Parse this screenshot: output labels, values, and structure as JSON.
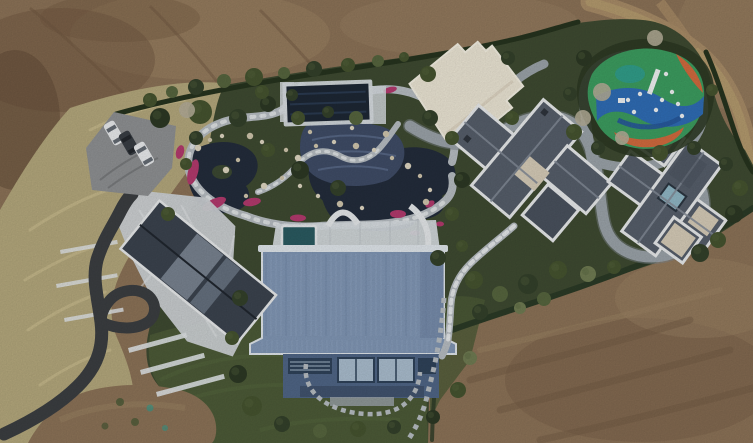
{
  "image": {
    "kind": "aerial drone photograph (top-down)",
    "subject": "Luxury landscaped estate compound surrounded by graded bare earth",
    "visible_text": "none"
  },
  "scene": {
    "surroundings": {
      "terrain": "bare brown dirt covering top-left, top-right and bottom-right",
      "dirt_track": "curving tan vehicle track in top-right corner",
      "bare_patch": "brown dirt patch at bottom-left with green spots"
    },
    "estate": {
      "boundary": "dark evergreen hedge line around the property",
      "garden": {
        "pond": "dark koi pond with rock edges and island",
        "cascade": "blue-gray stone cascade below pavilion",
        "paths": "winding light stone paths with white stepping stones",
        "flower_beds": "magenta flower drifts along pond and paths",
        "pavilion_pool": "dark navy rectangular pool/pavilion with white deck frame"
      },
      "buildings": [
        {
          "name": "stone-patio-house",
          "desc": "dark slate gable roof with glass skylight bands, white mosaic stone patio and terraced white steps"
        },
        {
          "name": "flat-roof-annex",
          "desc": "cream flat roof with notched corners"
        },
        {
          "name": "central-villa",
          "desc": "gray cross-plan hip roof with white trim and beige flat section"
        },
        {
          "name": "east-villa",
          "desc": "gray hip roof with white trim, beige flat corners and teal central skylight"
        },
        {
          "name": "blue-barn",
          "desc": "large steel-blue corrugated gable roof, window facade, rooftop terrace with plunge pool and white bridge"
        }
      ],
      "playground": "organic rubber-surface playground in green/blue/orange/teal swirls with white play equipment",
      "parking": {
        "cars": [
          {
            "color": "white"
          },
          {
            "color": "dark gray"
          },
          {
            "color": "white"
          }
        ],
        "surface": "gray pad in dry grass"
      },
      "driveway": "dark asphalt drive entering bottom-left with turnaround loop",
      "stairway": "stone stepping-stair path from central villa down to lawn",
      "vegetation": "dense evergreen shrubs and trees, several pale leafless trees, dry tan reed grass along the west side"
    }
  },
  "colors": {
    "dirt_base": "#8b7257",
    "dirt_dark": "#6f5740",
    "dirt_deep": "#5f4936",
    "dirt_light": "#9c8363",
    "dirt_pale": "#a78b67",
    "track_light": "#b49a6e",
    "dry_grass": "#b3a77c",
    "reed_light": "#cfc393",
    "garden_green": "#3e4a31",
    "lawn_green": "#4c5a37",
    "lawn_light": "#57683f",
    "hedge_dark": "#26331e",
    "hedge_mid": "#2b3a26",
    "shrub_deep": "#2c3824",
    "shrub_dark": "#33402a",
    "shrub_mid": "#45532f",
    "shrub_light": "#56653e",
    "shrub_pale": "#6f7b52",
    "tree_bare": "#b3ac97",
    "pond_water": "#232c3b",
    "island_green": "#3b4832",
    "cascade_blue": "#3f4c66",
    "cascade_line": "#5d6d8c",
    "stone_path": "#b6bcc1",
    "stone_white": "#e4e7e9",
    "rock_tan": "#cfc5ac",
    "rock_pale": "#ddd5c0",
    "flower_pink": "#b23a6d",
    "road_gray": "#9aa2a8",
    "road_edge": "#7e868c",
    "asphalt": "#3b3e41",
    "pad_gray": "#8e9092",
    "cream_roof": "#eae4d3",
    "cream_edge": "#f3efe2",
    "villa_roof": "#565e6a",
    "villa_roof_dark": "#49515d",
    "villa_ridge": "#838b97",
    "villa_trim": "#e7e9ea",
    "beige_flat": "#d5cbb7",
    "skylight_teal": "#8fb6c4",
    "pavilion_navy": "#1d2734",
    "pavilion_sheen": "#2a3a50",
    "deck_white": "#d6dbdf",
    "blue_roof": "#8096b4",
    "blue_roof_light": "#93a7c2",
    "blue_roof_dark": "#6d83a3",
    "ridge_cap": "#dfe5ea",
    "facade_blue": "#4f6585",
    "slat_blue": "#2f4259",
    "window_blue": "#a9bccd",
    "band_blue": "#41536e",
    "pool_teal": "#2a5a60",
    "play_green": "#3c9c5f",
    "play_blue": "#2f6cb4",
    "play_blue_dark": "#27589a",
    "play_orange": "#d06a3e",
    "play_teal": "#2f9e90",
    "equip_white": "#eef0f1",
    "car_white": "#e8eaec",
    "car_dark": "#383d43",
    "car_glass": "#646b73",
    "patio_stone": "#ccd1d4",
    "wall_white": "#dfe3e5",
    "roof_slate": "#3b434e",
    "roof_glass": "#7f8a97",
    "roof_glass2": "#6a7584"
  }
}
